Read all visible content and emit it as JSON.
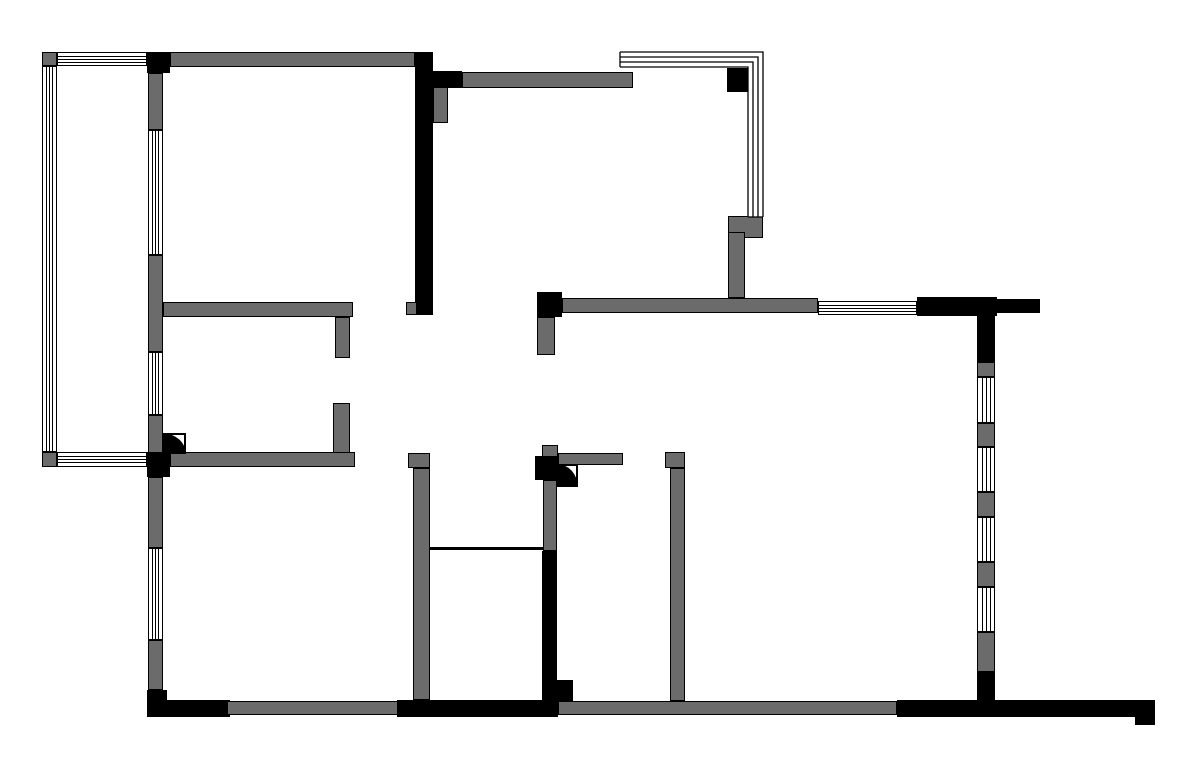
{
  "canvas": {
    "width": 1200,
    "height": 777,
    "background": "#ffffff"
  },
  "colors": {
    "wall_gray": "#6b6b6b",
    "wall_black": "#000000",
    "window_fill": "#ffffff",
    "line": "#000000"
  },
  "walls": [
    {
      "name": "balcony-corner-top",
      "x": 42,
      "y": 52,
      "w": 15,
      "h": 14,
      "color": "gray"
    },
    {
      "name": "top-wall-junction-black",
      "x": 147,
      "y": 52,
      "w": 23,
      "h": 21,
      "color": "black"
    },
    {
      "name": "balcony-corner-bottom",
      "x": 42,
      "y": 452,
      "w": 15,
      "h": 15,
      "color": "gray"
    },
    {
      "name": "left-junction-black",
      "x": 147,
      "y": 452,
      "w": 23,
      "h": 25,
      "color": "black"
    },
    {
      "name": "left-wall-seg1",
      "x": 148,
      "y": 73,
      "w": 15,
      "h": 57,
      "color": "gray"
    },
    {
      "name": "left-wall-seg2",
      "x": 148,
      "y": 255,
      "w": 15,
      "h": 97,
      "color": "gray"
    },
    {
      "name": "left-wall-seg3",
      "x": 148,
      "y": 415,
      "w": 15,
      "h": 38,
      "color": "gray"
    },
    {
      "name": "left-wall-seg4",
      "x": 148,
      "y": 477,
      "w": 15,
      "h": 71,
      "color": "gray"
    },
    {
      "name": "left-wall-seg5",
      "x": 148,
      "y": 640,
      "w": 15,
      "h": 50,
      "color": "gray"
    },
    {
      "name": "bottom-left-corner",
      "x": 147,
      "y": 690,
      "w": 20,
      "h": 27,
      "color": "black"
    },
    {
      "name": "top-wall",
      "x": 170,
      "y": 52,
      "w": 245,
      "h": 15,
      "color": "gray"
    },
    {
      "name": "center-black-wall",
      "x": 415,
      "y": 52,
      "w": 18,
      "h": 263,
      "color": "black"
    },
    {
      "name": "center-wall-notch",
      "x": 406,
      "y": 302,
      "w": 11,
      "h": 13,
      "color": "gray"
    },
    {
      "name": "kitchen-top-wall-black",
      "x": 433,
      "y": 71,
      "w": 29,
      "h": 17,
      "color": "black"
    },
    {
      "name": "kitchen-top-wall",
      "x": 462,
      "y": 72,
      "w": 171,
      "h": 16,
      "color": "gray"
    },
    {
      "name": "kitchen-column",
      "x": 433,
      "y": 87,
      "w": 15,
      "h": 36,
      "color": "gray"
    },
    {
      "name": "corner-window-column",
      "x": 727,
      "y": 68,
      "w": 21,
      "h": 24,
      "color": "black"
    },
    {
      "name": "corner-window-sill",
      "x": 728,
      "y": 216,
      "w": 35,
      "h": 22,
      "color": "gray"
    },
    {
      "name": "kitchen-right-wall",
      "x": 728,
      "y": 232,
      "w": 17,
      "h": 66,
      "color": "gray"
    },
    {
      "name": "bedroom1-bottom-wall",
      "x": 163,
      "y": 302,
      "w": 190,
      "h": 15,
      "color": "gray"
    },
    {
      "name": "bedroom1-wall-stub",
      "x": 335,
      "y": 317,
      "w": 15,
      "h": 41,
      "color": "gray"
    },
    {
      "name": "room2-wall-stub",
      "x": 333,
      "y": 403,
      "w": 17,
      "h": 50,
      "color": "gray"
    },
    {
      "name": "room2-bottom-wall",
      "x": 170,
      "y": 452,
      "w": 185,
      "h": 15,
      "color": "gray"
    },
    {
      "name": "living-top-junction",
      "x": 537,
      "y": 292,
      "w": 25,
      "h": 25,
      "color": "black"
    },
    {
      "name": "living-top-wall",
      "x": 562,
      "y": 298,
      "w": 256,
      "h": 15,
      "color": "gray"
    },
    {
      "name": "top-right-wall-black",
      "x": 917,
      "y": 297,
      "w": 80,
      "h": 19,
      "color": "black"
    },
    {
      "name": "top-right-wall-stub",
      "x": 997,
      "y": 299,
      "w": 43,
      "h": 14,
      "color": "black"
    },
    {
      "name": "living-top-stub",
      "x": 537,
      "y": 317,
      "w": 18,
      "h": 38,
      "color": "gray"
    },
    {
      "name": "right-wall-seg1",
      "x": 977,
      "y": 316,
      "w": 18,
      "h": 46,
      "color": "black"
    },
    {
      "name": "right-wall-seg2",
      "x": 977,
      "y": 362,
      "w": 18,
      "h": 15,
      "color": "gray"
    },
    {
      "name": "right-wall-seg3",
      "x": 977,
      "y": 423,
      "w": 18,
      "h": 24,
      "color": "gray"
    },
    {
      "name": "right-wall-seg4",
      "x": 977,
      "y": 492,
      "w": 18,
      "h": 25,
      "color": "gray"
    },
    {
      "name": "right-wall-seg5",
      "x": 977,
      "y": 562,
      "w": 18,
      "h": 25,
      "color": "gray"
    },
    {
      "name": "right-wall-seg6",
      "x": 977,
      "y": 632,
      "w": 18,
      "h": 40,
      "color": "gray"
    },
    {
      "name": "right-wall-seg7",
      "x": 977,
      "y": 672,
      "w": 18,
      "h": 30,
      "color": "black"
    },
    {
      "name": "bath-left-wall-cap",
      "x": 408,
      "y": 453,
      "w": 22,
      "h": 15,
      "color": "gray"
    },
    {
      "name": "bath-left-wall",
      "x": 413,
      "y": 468,
      "w": 17,
      "h": 232,
      "color": "gray"
    },
    {
      "name": "bath-divider-line",
      "x": 430,
      "y": 547,
      "w": 113,
      "h": 3,
      "color": "black"
    },
    {
      "name": "bath-right-wall-top-stub",
      "x": 542,
      "y": 445,
      "w": 16,
      "h": 12,
      "color": "gray"
    },
    {
      "name": "bath-right-junction",
      "x": 535,
      "y": 456,
      "w": 23,
      "h": 24,
      "color": "black"
    },
    {
      "name": "hall-wall-arm",
      "x": 558,
      "y": 453,
      "w": 65,
      "h": 12,
      "color": "gray"
    },
    {
      "name": "bath-right-wall-gray",
      "x": 543,
      "y": 480,
      "w": 14,
      "h": 71,
      "color": "gray"
    },
    {
      "name": "bath-right-wall-black",
      "x": 542,
      "y": 551,
      "w": 15,
      "h": 150,
      "color": "black"
    },
    {
      "name": "bath-right-wall-step",
      "x": 557,
      "y": 680,
      "w": 16,
      "h": 21,
      "color": "black"
    },
    {
      "name": "bedroom2-left-wall-cap",
      "x": 665,
      "y": 452,
      "w": 20,
      "h": 16,
      "color": "gray"
    },
    {
      "name": "bedroom2-left-wall",
      "x": 670,
      "y": 468,
      "w": 15,
      "h": 233,
      "color": "gray"
    },
    {
      "name": "bottom-wall-black1",
      "x": 160,
      "y": 700,
      "w": 70,
      "h": 17,
      "color": "black"
    },
    {
      "name": "bottom-wall-gray1",
      "x": 227,
      "y": 701,
      "w": 172,
      "h": 14,
      "color": "gray"
    },
    {
      "name": "bottom-wall-black2",
      "x": 397,
      "y": 700,
      "w": 161,
      "h": 17,
      "color": "black"
    },
    {
      "name": "bottom-wall-gray2",
      "x": 558,
      "y": 701,
      "w": 339,
      "h": 14,
      "color": "gray"
    },
    {
      "name": "bottom-wall-black3",
      "x": 897,
      "y": 700,
      "w": 258,
      "h": 17,
      "color": "black"
    },
    {
      "name": "bottom-wall-hook",
      "x": 1135,
      "y": 715,
      "w": 20,
      "h": 10,
      "color": "black"
    }
  ],
  "windows": [
    {
      "name": "balcony-window-top",
      "x": 57,
      "y": 52,
      "w": 90,
      "h": 14,
      "orientation": "h"
    },
    {
      "name": "balcony-window-left",
      "x": 42,
      "y": 66,
      "w": 15,
      "h": 386,
      "orientation": "v"
    },
    {
      "name": "balcony-window-bottom",
      "x": 57,
      "y": 452,
      "w": 90,
      "h": 15,
      "orientation": "h"
    },
    {
      "name": "bedroom1-window",
      "x": 148,
      "y": 130,
      "w": 15,
      "h": 125,
      "orientation": "v"
    },
    {
      "name": "room2-window",
      "x": 148,
      "y": 352,
      "w": 15,
      "h": 63,
      "orientation": "v"
    },
    {
      "name": "room3-window",
      "x": 148,
      "y": 548,
      "w": 15,
      "h": 92,
      "orientation": "v"
    },
    {
      "name": "top-right-window",
      "x": 818,
      "y": 301,
      "w": 99,
      "h": 14,
      "orientation": "h"
    },
    {
      "name": "right-window1",
      "x": 977,
      "y": 377,
      "w": 18,
      "h": 46,
      "orientation": "v"
    },
    {
      "name": "right-window2",
      "x": 977,
      "y": 447,
      "w": 18,
      "h": 45,
      "orientation": "v"
    },
    {
      "name": "right-window3",
      "x": 977,
      "y": 517,
      "w": 18,
      "h": 45,
      "orientation": "v"
    },
    {
      "name": "right-window4",
      "x": 977,
      "y": 587,
      "w": 18,
      "h": 45,
      "orientation": "v"
    }
  ],
  "corner_windows": [
    {
      "name": "kitchen-corner-window",
      "x": 620,
      "y": 52,
      "w": 143,
      "h": 165,
      "thickness": 15,
      "corner": "top-right"
    }
  ],
  "doors": [
    {
      "name": "room2-door",
      "x": 163,
      "y": 434,
      "w": 22,
      "h": 19
    },
    {
      "name": "bath-door",
      "x": 558,
      "y": 465,
      "w": 19,
      "h": 21
    }
  ]
}
